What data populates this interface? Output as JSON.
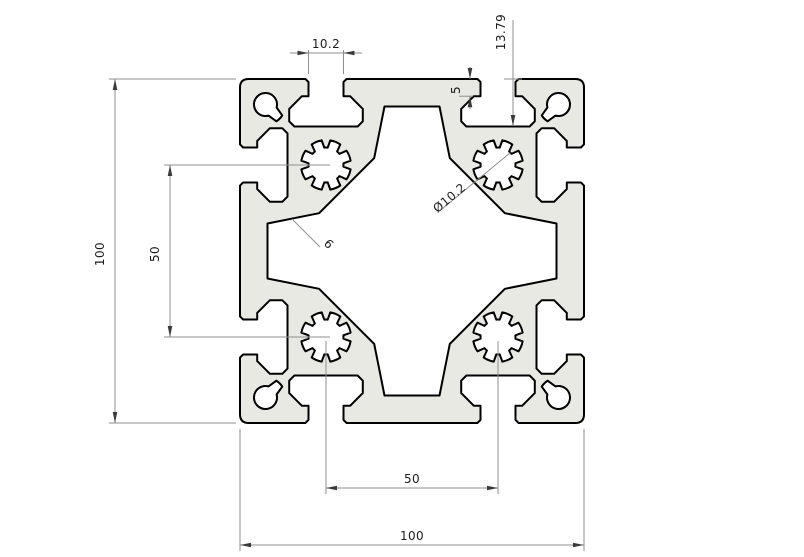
{
  "drawing": {
    "dimensions": {
      "slot_opening": "10.2",
      "slot_depth": "13.79",
      "lip_depth": "5",
      "overall_height": "100",
      "hole_spacing_vertical": "50",
      "core_hole_diameter": "Ø10.2",
      "wall_thickness": "6",
      "hole_spacing_horizontal": "50",
      "overall_width": "100"
    },
    "colors": {
      "body": "#e9e9e3",
      "outline": "#000000",
      "dimension_lines": "#8f8f8f",
      "text": "#1c1c1c",
      "background": "#ffffff"
    }
  }
}
